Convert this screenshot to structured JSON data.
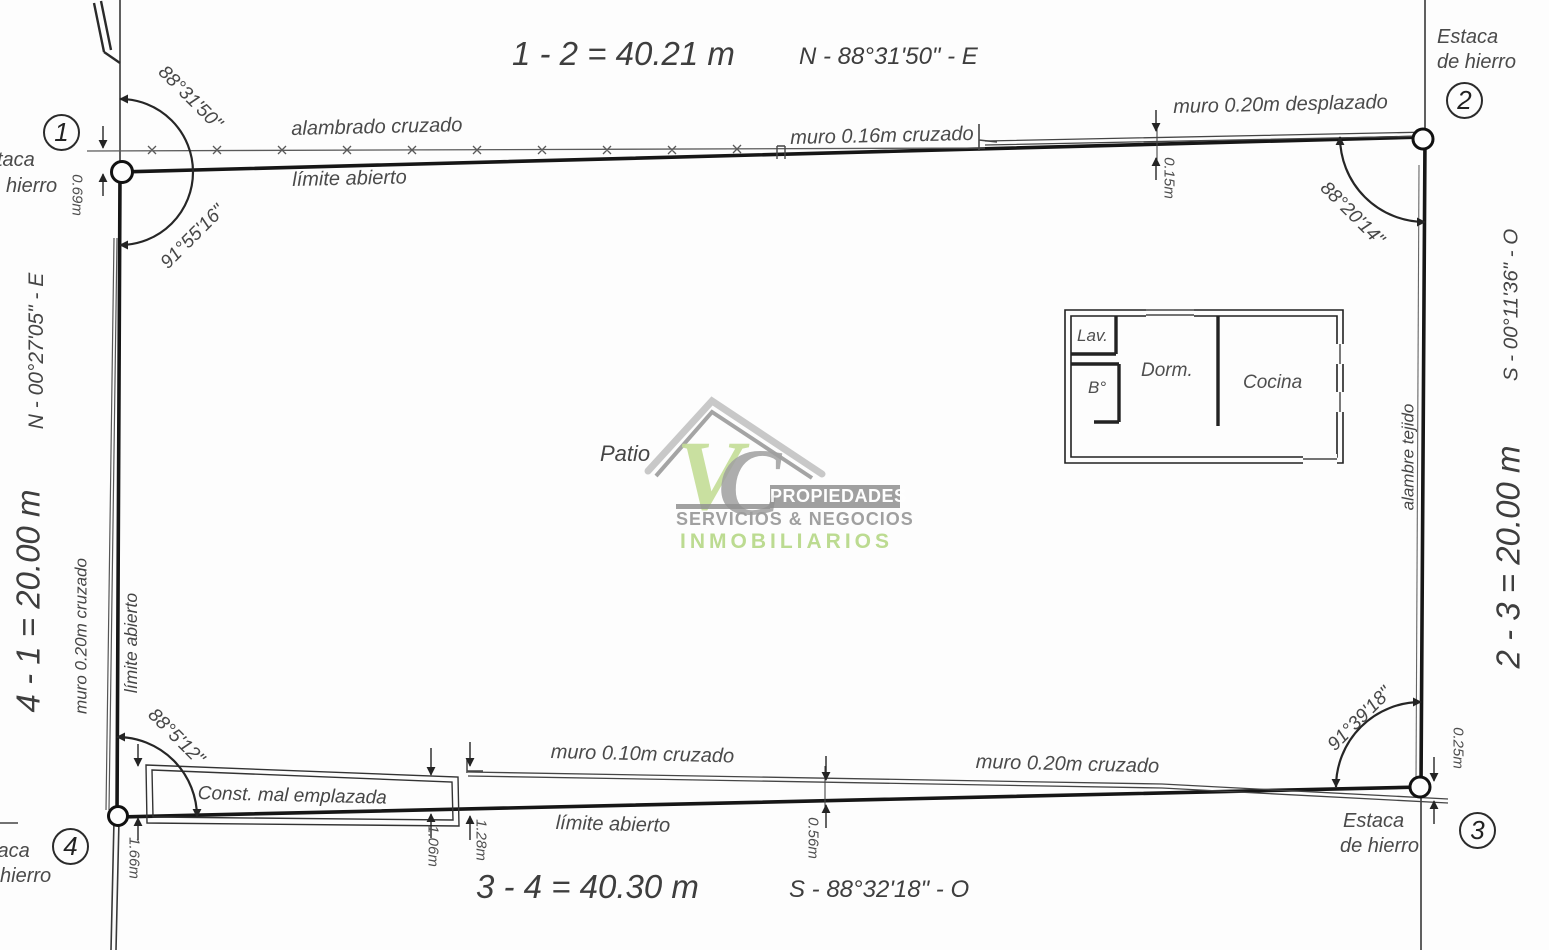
{
  "sides": {
    "top": {
      "dimension": "1 - 2 = 40.21 m",
      "bearing": "N - 88°31'50\" - E"
    },
    "right": {
      "dimension": "2 - 3 = 20.00 m",
      "bearing": "S - 00°11'36\" - O",
      "fence_label": "alambre tejido"
    },
    "bottom": {
      "dimension": "3 - 4 = 40.30 m",
      "bearing": "S - 88°32'18\" - O"
    },
    "left": {
      "dimension": "4 - 1 = 20.00 m",
      "bearing": "N - 00°27'05\" - E"
    }
  },
  "annotations": {
    "fence_top": "alambrado cruzado",
    "open_limit_top": "límite abierto",
    "wall_016_crossed": "muro 0.16m cruzado",
    "wall_020_displaced": "muro 0.20m desplazado",
    "wall_020_crossed_left": "muro 0.20m cruzado",
    "open_limit_left": "límite abierto",
    "wall_010_crossed": "muro 0.10m cruzado",
    "wall_020_crossed_bottom": "muro 0.20m cruzado",
    "open_limit_bottom": "límite abierto",
    "misplaced_construction": "Const. mal emplazada"
  },
  "offsets": {
    "o069": "0.69m",
    "o015": "0.15m",
    "o166": "1.66m",
    "o106": "1.06m",
    "o128": "1.28m",
    "o056": "0.56m",
    "o025": "0.25m"
  },
  "corners": {
    "c1": {
      "num": "1",
      "angle_upper": "88°31'50\"",
      "angle_lower": "91°55'16\"",
      "stake1": "taca",
      "stake2": "hierro"
    },
    "c2": {
      "num": "2",
      "angle": "88°20'14\"",
      "stake1": "Estaca",
      "stake2": "de hierro"
    },
    "c3": {
      "num": "3",
      "angle": "91°39'18\"",
      "stake1": "Estaca",
      "stake2": "de hierro"
    },
    "c4": {
      "num": "4",
      "angle": "88°5'12\"",
      "stake1": "taca",
      "stake2": "hierro"
    }
  },
  "interior": {
    "patio": "Patio",
    "rooms": {
      "laundry": "Lav.",
      "bathroom": "B°",
      "bedroom": "Dorm.",
      "kitchen": "Cocina"
    }
  },
  "watermark": {
    "monogram_v": "V",
    "monogram_c": "C",
    "band": "PROPIEDADES",
    "line2": "SERVICIOS & NEGOCIOS",
    "line3": "INMOBILIARIOS",
    "green": "#b9da8c",
    "gray": "#9a9a9a",
    "band_gray": "#8f8f8f"
  }
}
